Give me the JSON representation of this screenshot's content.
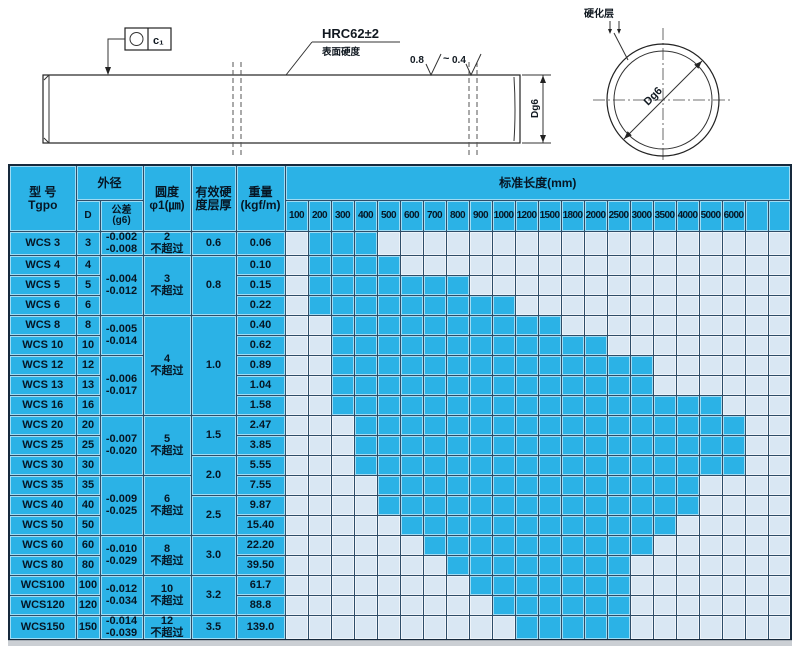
{
  "drawing": {
    "tolerance_frame": {
      "symbol_name": "circularity",
      "value": "c₁"
    },
    "hardness_label": "HRC62±2",
    "hardness_sub": "表面硬度",
    "roughness_high": "0.8",
    "roughness_tilde": "~",
    "roughness_low": "0.4",
    "shaft_dim": "Dg6",
    "section_dim": "Dg6",
    "case_layer_label": "硬化层"
  },
  "table": {
    "header": {
      "model": "型 号\nTgpo",
      "outer_dia": "外径",
      "d": "D",
      "tolerance": "公差\n(g6)",
      "roundness": "圆度\nφ1(㎛)",
      "case_depth": "有效硬\n度层厚",
      "weight": "重量\n(kgf/m)",
      "std_length": "标准长度(mm)"
    },
    "lengths": [
      100,
      200,
      300,
      400,
      500,
      600,
      700,
      800,
      900,
      1000,
      1200,
      1500,
      1800,
      2000,
      2500,
      3000,
      3500,
      4000,
      5000,
      6000,
      "",
      ""
    ],
    "roundness_note": "不超过",
    "tolerance_groups": [
      {
        "span": 1,
        "text": "-0.002\n-0.008"
      },
      {
        "span": 3,
        "text": "-0.004\n-0.012"
      },
      {
        "span": 2,
        "text": "-0.005\n-0.014"
      },
      {
        "span": 3,
        "text": "-0.006\n-0.017"
      },
      {
        "span": 3,
        "text": "-0.007\n-0.020"
      },
      {
        "span": 3,
        "text": "-0.009\n-0.025"
      },
      {
        "span": 2,
        "text": "-0.010\n-0.029"
      },
      {
        "span": 2,
        "text": "-0.012\n-0.034"
      },
      {
        "span": 1,
        "text": "-0.014\n-0.039"
      }
    ],
    "roundness_groups": [
      {
        "span": 1,
        "value": "2"
      },
      {
        "span": 3,
        "value": "3"
      },
      {
        "span": 5,
        "value": "4"
      },
      {
        "span": 3,
        "value": "5"
      },
      {
        "span": 3,
        "value": "6"
      },
      {
        "span": 2,
        "value": "8"
      },
      {
        "span": 2,
        "value": "10"
      },
      {
        "span": 1,
        "value": "12"
      }
    ],
    "case_depth_groups": [
      {
        "span": 1,
        "value": "0.6"
      },
      {
        "span": 3,
        "value": "0.8"
      },
      {
        "span": 5,
        "value": "1.0"
      },
      {
        "span": 2,
        "value": "1.5"
      },
      {
        "span": 2,
        "value": "2.0"
      },
      {
        "span": 2,
        "value": "2.5"
      },
      {
        "span": 2,
        "value": "3.0"
      },
      {
        "span": 2,
        "value": "3.2"
      },
      {
        "span": 1,
        "value": "3.5"
      }
    ],
    "rows": [
      {
        "model": "WCS 3",
        "d": "3",
        "weight": "0.06",
        "len_from": 200,
        "len_to": 400
      },
      {
        "model": "WCS 4",
        "d": "4",
        "weight": "0.10",
        "len_from": 200,
        "len_to": 500
      },
      {
        "model": "WCS 5",
        "d": "5",
        "weight": "0.15",
        "len_from": 200,
        "len_to": 800
      },
      {
        "model": "WCS 6",
        "d": "6",
        "weight": "0.22",
        "len_from": 200,
        "len_to": 1000
      },
      {
        "model": "WCS 8",
        "d": "8",
        "weight": "0.40",
        "len_from": 300,
        "len_to": 1500
      },
      {
        "model": "WCS 10",
        "d": "10",
        "weight": "0.62",
        "len_from": 300,
        "len_to": 2000
      },
      {
        "model": "WCS 12",
        "d": "12",
        "weight": "0.89",
        "len_from": 300,
        "len_to": 3000
      },
      {
        "model": "WCS 13",
        "d": "13",
        "weight": "1.04",
        "len_from": 300,
        "len_to": 3000
      },
      {
        "model": "WCS 16",
        "d": "16",
        "weight": "1.58",
        "len_from": 300,
        "len_to": 5000
      },
      {
        "model": "WCS 20",
        "d": "20",
        "weight": "2.47",
        "len_from": 400,
        "len_to": 6000
      },
      {
        "model": "WCS 25",
        "d": "25",
        "weight": "3.85",
        "len_from": 400,
        "len_to": 6000
      },
      {
        "model": "WCS 30",
        "d": "30",
        "weight": "5.55",
        "len_from": 400,
        "len_to": 6000
      },
      {
        "model": "WCS 35",
        "d": "35",
        "weight": "7.55",
        "len_from": 500,
        "len_to": 4000
      },
      {
        "model": "WCS 40",
        "d": "40",
        "weight": "9.87",
        "len_from": 500,
        "len_to": 4000
      },
      {
        "model": "WCS 50",
        "d": "50",
        "weight": "15.40",
        "len_from": 600,
        "len_to": 3500
      },
      {
        "model": "WCS 60",
        "d": "60",
        "weight": "22.20",
        "len_from": 700,
        "len_to": 3000
      },
      {
        "model": "WCS 80",
        "d": "80",
        "weight": "39.50",
        "len_from": 800,
        "len_to": 2500
      },
      {
        "model": "WCS100",
        "d": "100",
        "weight": "61.7",
        "len_from": 900,
        "len_to": 2500
      },
      {
        "model": "WCS120",
        "d": "120",
        "weight": "88.8",
        "len_from": 1000,
        "len_to": 2500
      },
      {
        "model": "WCS150",
        "d": "150",
        "weight": "139.0",
        "len_from": 1200,
        "len_to": 2500
      }
    ],
    "colors": {
      "available": "#2bb2e6",
      "unavailable": "#d9e7f3"
    },
    "col_widths": [
      67,
      24,
      43,
      48,
      45,
      49
    ]
  }
}
